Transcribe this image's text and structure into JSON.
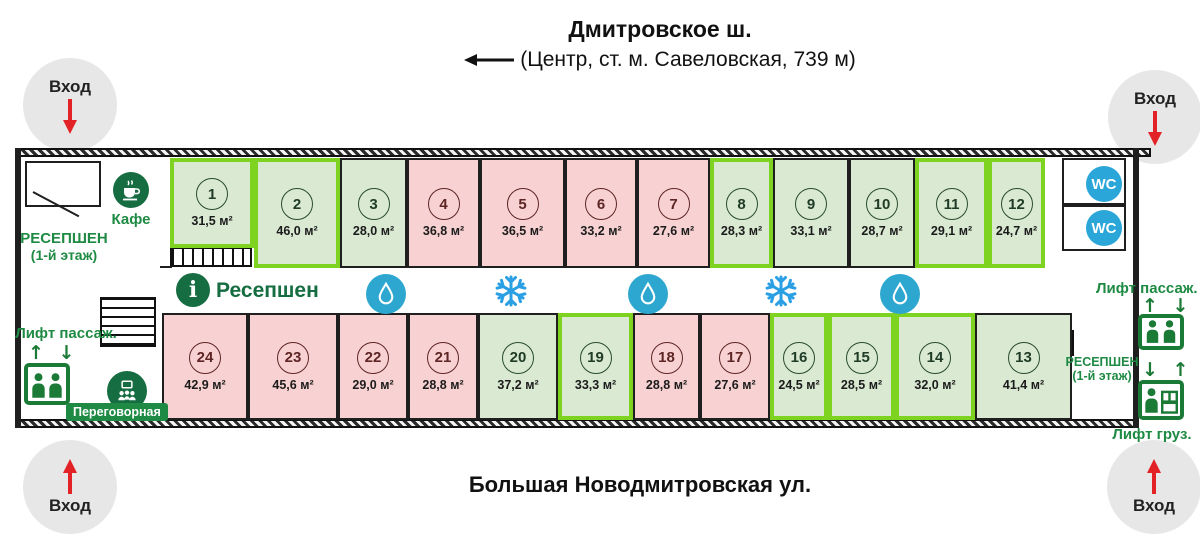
{
  "colors": {
    "room_green_fill": "#d9e9d2",
    "room_pink_fill": "#f8d2d2",
    "highlight_border": "#7ed321",
    "wall": "#1f1f1f",
    "label_green": "#1e8a43",
    "icon_dark_green": "#156d41",
    "blue_icon_circle": "#2da7cf",
    "wc_blue": "#2aa6d8",
    "snowflake_blue": "#2b9fe3",
    "entrance_arrow_red": "#e32227",
    "entrance_circle_grey": "#e7e7e7"
  },
  "streets": {
    "top_title": "Дмитровское ш.",
    "top_subtitle": "(Центр, ст. м. Савеловская, 739 м)",
    "bottom_title": "Большая Новодмитровская ул."
  },
  "entrance_label": "Вход",
  "corridor": {
    "reception_label": "Ресепшен"
  },
  "left_wing": {
    "cafe_label": "Кафе",
    "reception_line1": "РЕСЕПШЕН",
    "reception_line2": "(1-й этаж)",
    "lift_passenger_label": "Лифт пассаж.",
    "lift_arrows_up_down": "↑ ↓",
    "meeting_room_label": "Переговорная"
  },
  "right_wing": {
    "wc_label": "WC",
    "lift_passenger_label": "Лифт пассаж.",
    "lift_arrows_up_down": "↑ ↓",
    "lift_arrows_down_up": "↓ ↑",
    "reception_line1": "РЕСЕПШЕН",
    "reception_line2": "(1-й этаж)",
    "lift_freight_label": "Лифт груз."
  },
  "rooms": {
    "top": [
      {
        "num": "1",
        "area": "31,5 м²",
        "type": "green",
        "highlighted": true
      },
      {
        "num": "2",
        "area": "46,0 м²",
        "type": "green",
        "highlighted": true
      },
      {
        "num": "3",
        "area": "28,0 м²",
        "type": "green",
        "highlighted": false
      },
      {
        "num": "4",
        "area": "36,8 м²",
        "type": "pink",
        "highlighted": false
      },
      {
        "num": "5",
        "area": "36,5 м²",
        "type": "pink",
        "highlighted": false
      },
      {
        "num": "6",
        "area": "33,2 м²",
        "type": "pink",
        "highlighted": false
      },
      {
        "num": "7",
        "area": "27,6 м²",
        "type": "pink",
        "highlighted": false
      },
      {
        "num": "8",
        "area": "28,3 м²",
        "type": "green",
        "highlighted": true
      },
      {
        "num": "9",
        "area": "33,1 м²",
        "type": "green",
        "highlighted": false
      },
      {
        "num": "10",
        "area": "28,7 м²",
        "type": "green",
        "highlighted": false
      },
      {
        "num": "11",
        "area": "29,1 м²",
        "type": "green",
        "highlighted": true
      },
      {
        "num": "12",
        "area": "24,7 м²",
        "type": "green",
        "highlighted": true
      }
    ],
    "bottom": [
      {
        "num": "24",
        "area": "42,9 м²",
        "type": "pink",
        "highlighted": false
      },
      {
        "num": "23",
        "area": "45,6 м²",
        "type": "pink",
        "highlighted": false
      },
      {
        "num": "22",
        "area": "29,0 м²",
        "type": "pink",
        "highlighted": false
      },
      {
        "num": "21",
        "area": "28,8 м²",
        "type": "pink",
        "highlighted": false
      },
      {
        "num": "20",
        "area": "37,2 м²",
        "type": "green",
        "highlighted": false
      },
      {
        "num": "19",
        "area": "33,3 м²",
        "type": "green",
        "highlighted": true
      },
      {
        "num": "18",
        "area": "28,8 м²",
        "type": "pink",
        "highlighted": false
      },
      {
        "num": "17",
        "area": "27,6 м²",
        "type": "pink",
        "highlighted": false
      },
      {
        "num": "16",
        "area": "24,5 м²",
        "type": "green",
        "highlighted": true
      },
      {
        "num": "15",
        "area": "28,5 м²",
        "type": "green",
        "highlighted": true
      },
      {
        "num": "14",
        "area": "32,0 м²",
        "type": "green",
        "highlighted": true
      },
      {
        "num": "13",
        "area": "41,4 м²",
        "type": "green",
        "highlighted": false
      }
    ]
  }
}
